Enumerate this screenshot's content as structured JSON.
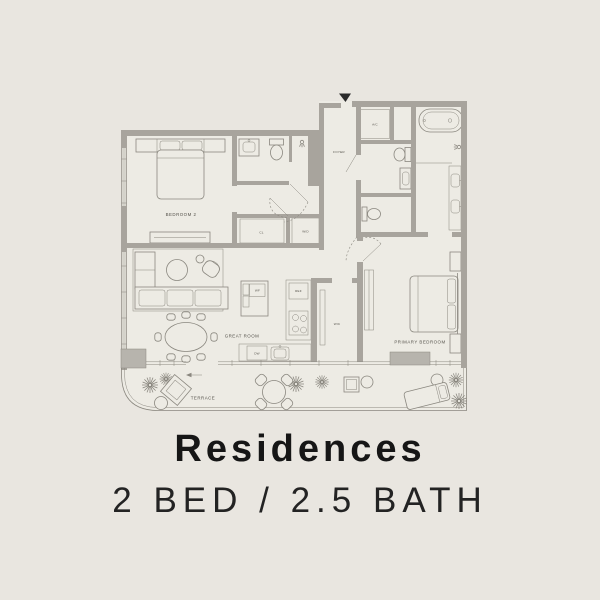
{
  "title": "Residences",
  "subtitle": "2 BED / 2.5 BATH",
  "floor_plan": {
    "labels": {
      "bedroom_2": "BEDROOM 2",
      "foyer": "FOYER",
      "ac_closet": "A/C",
      "closet": "CL",
      "washer_dryer": "W/D",
      "walk_in_closet": "WIC",
      "wine_fridge": "WF",
      "refrigerator": "REF",
      "dishwasher": "DW",
      "great_room": "GREAT ROOM",
      "primary_bedroom": "PRIMARY BEDROOM",
      "terrace": "TERRACE"
    },
    "colors": {
      "background": "#e9e6e0",
      "floor": "#edebe4",
      "wall": "#a8a49d",
      "line": "#8a877f",
      "accent": "#b7b4ad",
      "label_text": "#55524b",
      "title_text": "#161616"
    }
  }
}
